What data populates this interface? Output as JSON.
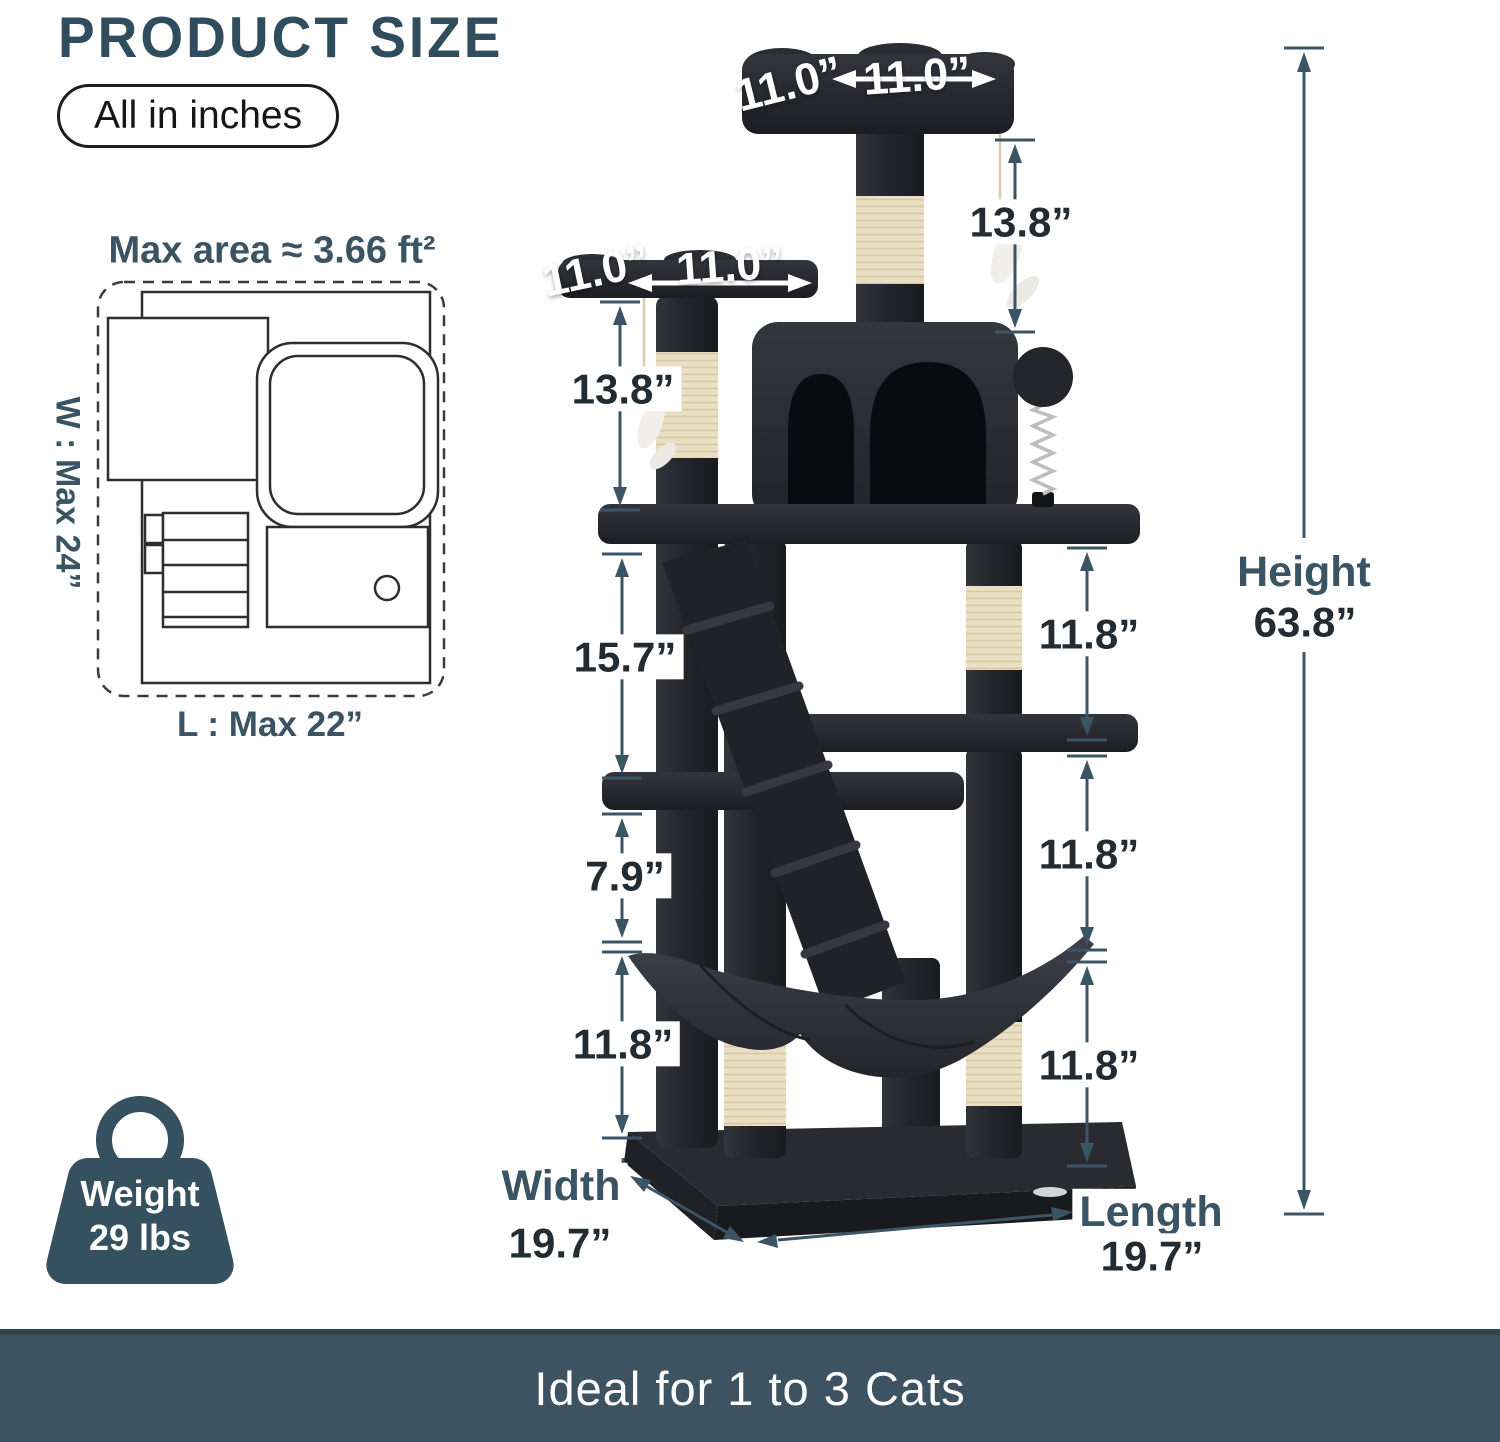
{
  "header": {
    "title": "PRODUCT SIZE",
    "unit_badge": "All in inches"
  },
  "floorplan": {
    "max_area": "Max area ≈ 3.66 ft²",
    "width_max": "W : Max 24”",
    "length_max": "L : Max 22”"
  },
  "weight": {
    "label": "Weight",
    "value": "29 lbs"
  },
  "dims": {
    "top_platform_depth": "11.0”",
    "top_platform_width": "11.0”",
    "left_platform_depth": "11.0”",
    "left_platform_width": "11.0”",
    "post_top": "13.8”",
    "post_left": "13.8”",
    "left_section_1": "15.7”",
    "left_section_2": "7.9”",
    "left_section_3": "11.8”",
    "right_section_1": "11.8”",
    "right_section_2": "11.8”",
    "right_section_3": "11.8”"
  },
  "height": {
    "label": "Height",
    "value": "63.8”"
  },
  "width": {
    "label": "Width",
    "value": "19.7”"
  },
  "length": {
    "label": "Length",
    "value": "19.7”"
  },
  "banner": {
    "text": "Ideal for 1 to 3 Cats"
  },
  "colors": {
    "accent_title": "#2f4d5c",
    "annotation_line": "#3c5565",
    "dim_number_text": "#232c33",
    "dim_word_text": "#3a5463",
    "banner_bg": "#3d5361",
    "tree_plush": "#26272d",
    "sisal": "#eadfc5"
  }
}
